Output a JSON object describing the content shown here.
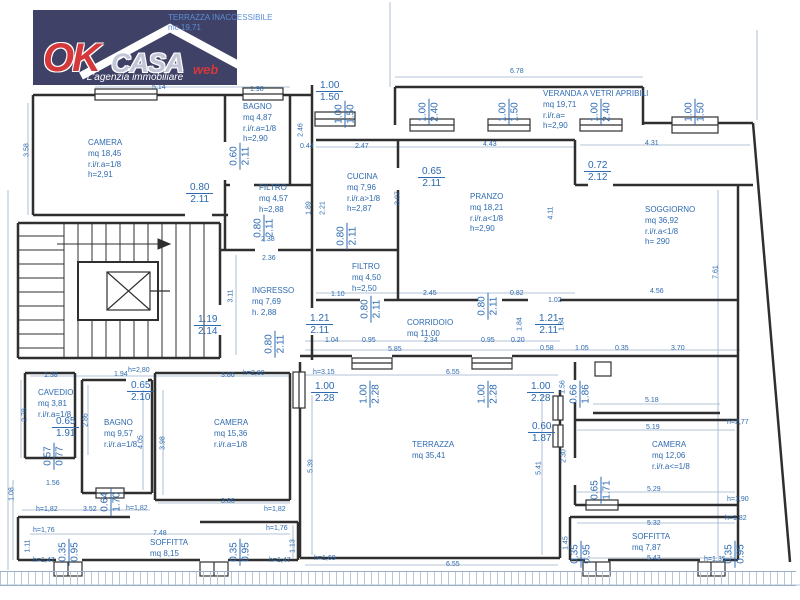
{
  "logo": {
    "ok": "OK",
    "casa": "CASA",
    "web": "web",
    "tagline": "L'agenzia immobiliare",
    "bg_color": "#3f4166",
    "accent_color": "#d5383b"
  },
  "annotations": {
    "top_note_line1": "TERRAZZA INACCESSIBILE",
    "top_note_line2": "mc 19,71"
  },
  "colors": {
    "dimension_text": "#2e6ab0",
    "wall": "#2f2f2f",
    "dimension_line": "#9ab0c8"
  },
  "rooms": [
    {
      "name": "CAMERA",
      "lines": [
        "mq 18,45",
        "r.i/r.a=1/8",
        "h=2,91"
      ],
      "x": 88,
      "y": 138
    },
    {
      "name": "BAGNO",
      "lines": [
        "mq 4,87",
        "r.i/r.a=1/8",
        "h=2,90"
      ],
      "x": 243,
      "y": 102
    },
    {
      "name": "FILTRO",
      "lines": [
        "mq 4,57",
        "h=2,88"
      ],
      "x": 259,
      "y": 183
    },
    {
      "name": "CUCINA",
      "lines": [
        "mq 7,96",
        "r.i/r.a>1/8",
        "h=2,87"
      ],
      "x": 347,
      "y": 172
    },
    {
      "name": "PRANZO",
      "lines": [
        "mq 18,21",
        "r.i/r.a<1/8",
        "h=2,90"
      ],
      "x": 470,
      "y": 192
    },
    {
      "name": "VERANDA A VETRI APRIBILI",
      "lines": [
        "mq 19,71",
        "r.i/r.a=",
        "h=2,90"
      ],
      "x": 543,
      "y": 89
    },
    {
      "name": "SOGGIORNO",
      "lines": [
        "mq 36,92",
        "r.i/r.a<1/8",
        "h= 290"
      ],
      "x": 645,
      "y": 205
    },
    {
      "name": "INGRESSO",
      "lines": [
        "mq 7,69",
        "h. 2,88"
      ],
      "x": 252,
      "y": 286
    },
    {
      "name": "FILTRO",
      "lines": [
        "mq 4,50",
        "h=2,50"
      ],
      "x": 352,
      "y": 262
    },
    {
      "name": "CORRIDOIO",
      "lines": [
        "mq 11,00"
      ],
      "x": 407,
      "y": 318
    },
    {
      "name": "CAVEDIO",
      "lines": [
        "mq 3,81",
        "r.i/r.a=1/8"
      ],
      "x": 38,
      "y": 388
    },
    {
      "name": "BAGNO",
      "lines": [
        "mq 9,57",
        "r.i/r.a=1/8"
      ],
      "x": 104,
      "y": 418
    },
    {
      "name": "CAMERA",
      "lines": [
        "mq 15,36",
        "r.i/r.a=1/8"
      ],
      "x": 214,
      "y": 418
    },
    {
      "name": "TERRAZZA",
      "lines": [
        "mq 35,41"
      ],
      "x": 412,
      "y": 440
    },
    {
      "name": "CAMERA",
      "lines": [
        "mq 12,06",
        "r.i/r.a<=1/8"
      ],
      "x": 652,
      "y": 440
    },
    {
      "name": "SOFFITTA",
      "lines": [
        "mq 8,15"
      ],
      "x": 150,
      "y": 538
    },
    {
      "name": "SOFFITTA",
      "lines": [
        "mq 7,87"
      ],
      "x": 632,
      "y": 532
    }
  ],
  "door_dims": [
    {
      "t": "1.00",
      "b": "1.20",
      "x": 40,
      "y": 28,
      "rot": true
    },
    {
      "t": "1.45",
      "b": "1.50",
      "x": 146,
      "y": 30,
      "rot": true
    },
    {
      "t": "1.00",
      "b": "1.50",
      "x": 316,
      "y": 80,
      "rot": false
    },
    {
      "t": "1.00",
      "b": "1.50",
      "x": 336,
      "y": 98,
      "rot": true
    },
    {
      "t": "1.00",
      "b": "2.40",
      "x": 420,
      "y": 96,
      "rot": true
    },
    {
      "t": "1.00",
      "b": "1.50",
      "x": 500,
      "y": 96,
      "rot": true
    },
    {
      "t": "1.00",
      "b": "2.40",
      "x": 592,
      "y": 96,
      "rot": true
    },
    {
      "t": "1.00",
      "b": "1.50",
      "x": 686,
      "y": 96,
      "rot": true
    },
    {
      "t": "0.60",
      "b": "2.11",
      "x": 231,
      "y": 140,
      "rot": true
    },
    {
      "t": "0.80",
      "b": "2.11",
      "x": 186,
      "y": 182,
      "rot": false
    },
    {
      "t": "0.80",
      "b": "2.11",
      "x": 255,
      "y": 212,
      "rot": true
    },
    {
      "t": "0.80",
      "b": "2.11",
      "x": 338,
      "y": 220,
      "rot": true
    },
    {
      "t": "0.65",
      "b": "2.11",
      "x": 418,
      "y": 166,
      "rot": false
    },
    {
      "t": "0.72",
      "b": "2.12",
      "x": 584,
      "y": 160,
      "rot": false
    },
    {
      "t": "1.19",
      "b": "2.14",
      "x": 194,
      "y": 314,
      "rot": false
    },
    {
      "t": "0.80",
      "b": "2.11",
      "x": 266,
      "y": 328,
      "rot": true
    },
    {
      "t": "1.21",
      "b": "2.11",
      "x": 306,
      "y": 313,
      "rot": false
    },
    {
      "t": "0.80",
      "b": "2.11",
      "x": 362,
      "y": 293,
      "rot": true
    },
    {
      "t": "0.80",
      "b": "2.11",
      "x": 479,
      "y": 290,
      "rot": true
    },
    {
      "t": "1.21",
      "b": "2.11",
      "x": 535,
      "y": 313,
      "rot": false
    },
    {
      "t": "0.65",
      "b": "2.10",
      "x": 127,
      "y": 380,
      "rot": false
    },
    {
      "t": "0.65",
      "b": "1.91",
      "x": 52,
      "y": 416,
      "rot": false
    },
    {
      "t": "0.57",
      "b": "0.77",
      "x": 45,
      "y": 440,
      "rot": true
    },
    {
      "t": "0.64",
      "b": "1.70",
      "x": 102,
      "y": 486,
      "rot": true
    },
    {
      "t": "1.00",
      "b": "2.28",
      "x": 311,
      "y": 381,
      "rot": false
    },
    {
      "t": "1.00",
      "b": "2.28",
      "x": 361,
      "y": 378,
      "rot": true
    },
    {
      "t": "1.00",
      "b": "2.28",
      "x": 479,
      "y": 378,
      "rot": true
    },
    {
      "t": "1.00",
      "b": "2.28",
      "x": 527,
      "y": 381,
      "rot": false
    },
    {
      "t": "0.66",
      "b": "1.86",
      "x": 571,
      "y": 378,
      "rot": true
    },
    {
      "t": "0.60",
      "b": "1.87",
      "x": 528,
      "y": 421,
      "rot": false
    },
    {
      "t": "0.65",
      "b": "1.71",
      "x": 592,
      "y": 474,
      "rot": true
    },
    {
      "t": "0.35",
      "b": "0.95",
      "x": 60,
      "y": 536,
      "rot": true
    },
    {
      "t": "0.35",
      "b": "0.95",
      "x": 231,
      "y": 536,
      "rot": true
    },
    {
      "t": "0.35",
      "b": "0.95",
      "x": 572,
      "y": 538,
      "rot": true
    },
    {
      "t": "0.35",
      "b": "0.95",
      "x": 726,
      "y": 538,
      "rot": true
    }
  ],
  "measures": [
    {
      "t": "5.14",
      "x": 152,
      "y": 84
    },
    {
      "t": "1.98",
      "x": 250,
      "y": 86
    },
    {
      "t": "6.78",
      "x": 510,
      "y": 68
    },
    {
      "t": "0.44",
      "x": 300,
      "y": 143
    },
    {
      "t": "2.47",
      "x": 355,
      "y": 143
    },
    {
      "t": "4.43",
      "x": 483,
      "y": 141
    },
    {
      "t": "4.31",
      "x": 645,
      "y": 140
    },
    {
      "t": "3.58",
      "x": 27,
      "y": 150,
      "v": true
    },
    {
      "t": "2.46",
      "x": 301,
      "y": 130,
      "v": true
    },
    {
      "t": "1.89",
      "x": 309,
      "y": 208,
      "v": true
    },
    {
      "t": "2.21",
      "x": 323,
      "y": 208,
      "v": true
    },
    {
      "t": "3.07",
      "x": 398,
      "y": 198,
      "v": true
    },
    {
      "t": "4.11",
      "x": 551,
      "y": 213,
      "v": true
    },
    {
      "t": "7.61",
      "x": 716,
      "y": 272,
      "v": true
    },
    {
      "t": "2.38",
      "x": 261,
      "y": 236
    },
    {
      "t": "2.36",
      "x": 262,
      "y": 255
    },
    {
      "t": "3.11",
      "x": 231,
      "y": 296,
      "v": true
    },
    {
      "t": "1.10",
      "x": 331,
      "y": 291
    },
    {
      "t": "2.45",
      "x": 423,
      "y": 290
    },
    {
      "t": "0.82",
      "x": 510,
      "y": 290
    },
    {
      "t": "1.02",
      "x": 548,
      "y": 297
    },
    {
      "t": "4.56",
      "x": 650,
      "y": 288
    },
    {
      "t": "1.84",
      "x": 520,
      "y": 324,
      "v": true
    },
    {
      "t": "1.84",
      "x": 562,
      "y": 324,
      "v": true
    },
    {
      "t": "1.04",
      "x": 325,
      "y": 337
    },
    {
      "t": "0.95",
      "x": 362,
      "y": 337
    },
    {
      "t": "2.34",
      "x": 424,
      "y": 337
    },
    {
      "t": "0.95",
      "x": 481,
      "y": 337
    },
    {
      "t": "0.20",
      "x": 511,
      "y": 337
    },
    {
      "t": "5.85",
      "x": 388,
      "y": 346
    },
    {
      "t": "0.58",
      "x": 540,
      "y": 345
    },
    {
      "t": "1.05",
      "x": 575,
      "y": 345
    },
    {
      "t": "0.35",
      "x": 615,
      "y": 345
    },
    {
      "t": "3.70",
      "x": 671,
      "y": 345
    },
    {
      "t": "h=3.15",
      "x": 313,
      "y": 369
    },
    {
      "t": "6.55",
      "x": 446,
      "y": 369
    },
    {
      "t": "1.38",
      "x": 44,
      "y": 372
    },
    {
      "t": "1.94",
      "x": 114,
      "y": 371
    },
    {
      "t": "h=2,80",
      "x": 128,
      "y": 367
    },
    {
      "t": "3.86",
      "x": 221,
      "y": 372
    },
    {
      "t": "h=2,80",
      "x": 243,
      "y": 370
    },
    {
      "t": "2.78",
      "x": 25,
      "y": 415,
      "v": true
    },
    {
      "t": "2.86",
      "x": 86,
      "y": 420,
      "v": true
    },
    {
      "t": "4.05",
      "x": 141,
      "y": 442,
      "v": true
    },
    {
      "t": "3.98",
      "x": 163,
      "y": 443,
      "v": true
    },
    {
      "t": "5.18",
      "x": 645,
      "y": 397
    },
    {
      "t": "5.19",
      "x": 646,
      "y": 424
    },
    {
      "t": "h=2,77",
      "x": 727,
      "y": 419
    },
    {
      "t": "1.56",
      "x": 563,
      "y": 387,
      "v": true
    },
    {
      "t": "2.30",
      "x": 564,
      "y": 456,
      "v": true
    },
    {
      "t": "5.39",
      "x": 311,
      "y": 466,
      "v": true
    },
    {
      "t": "5.41",
      "x": 539,
      "y": 468,
      "v": true
    },
    {
      "t": "1.56",
      "x": 46,
      "y": 480
    },
    {
      "t": "1.08",
      "x": 12,
      "y": 494,
      "v": true
    },
    {
      "t": "h=1,82",
      "x": 36,
      "y": 506
    },
    {
      "t": "3.52",
      "x": 83,
      "y": 506
    },
    {
      "t": "h=1,82",
      "x": 126,
      "y": 505
    },
    {
      "t": "3.86",
      "x": 221,
      "y": 498
    },
    {
      "t": "h=1,82",
      "x": 264,
      "y": 506
    },
    {
      "t": "7.48",
      "x": 153,
      "y": 530
    },
    {
      "t": "h=1,76",
      "x": 33,
      "y": 527
    },
    {
      "t": "h=1,76",
      "x": 266,
      "y": 525
    },
    {
      "t": "1.11",
      "x": 28,
      "y": 546,
      "v": true
    },
    {
      "t": "1.13",
      "x": 293,
      "y": 546,
      "v": true
    },
    {
      "t": "h=1,47",
      "x": 33,
      "y": 557
    },
    {
      "t": "h=1,47",
      "x": 269,
      "y": 557
    },
    {
      "t": "h=1,69",
      "x": 314,
      "y": 555
    },
    {
      "t": "6.55",
      "x": 446,
      "y": 561
    },
    {
      "t": "5.29",
      "x": 647,
      "y": 486
    },
    {
      "t": "h=1,90",
      "x": 727,
      "y": 496
    },
    {
      "t": "5.32",
      "x": 647,
      "y": 520
    },
    {
      "t": "h=1,82",
      "x": 725,
      "y": 515
    },
    {
      "t": "1.45",
      "x": 566,
      "y": 543,
      "v": true
    },
    {
      "t": "5.43",
      "x": 647,
      "y": 555
    },
    {
      "t": "h=1,35",
      "x": 704,
      "y": 556
    }
  ]
}
